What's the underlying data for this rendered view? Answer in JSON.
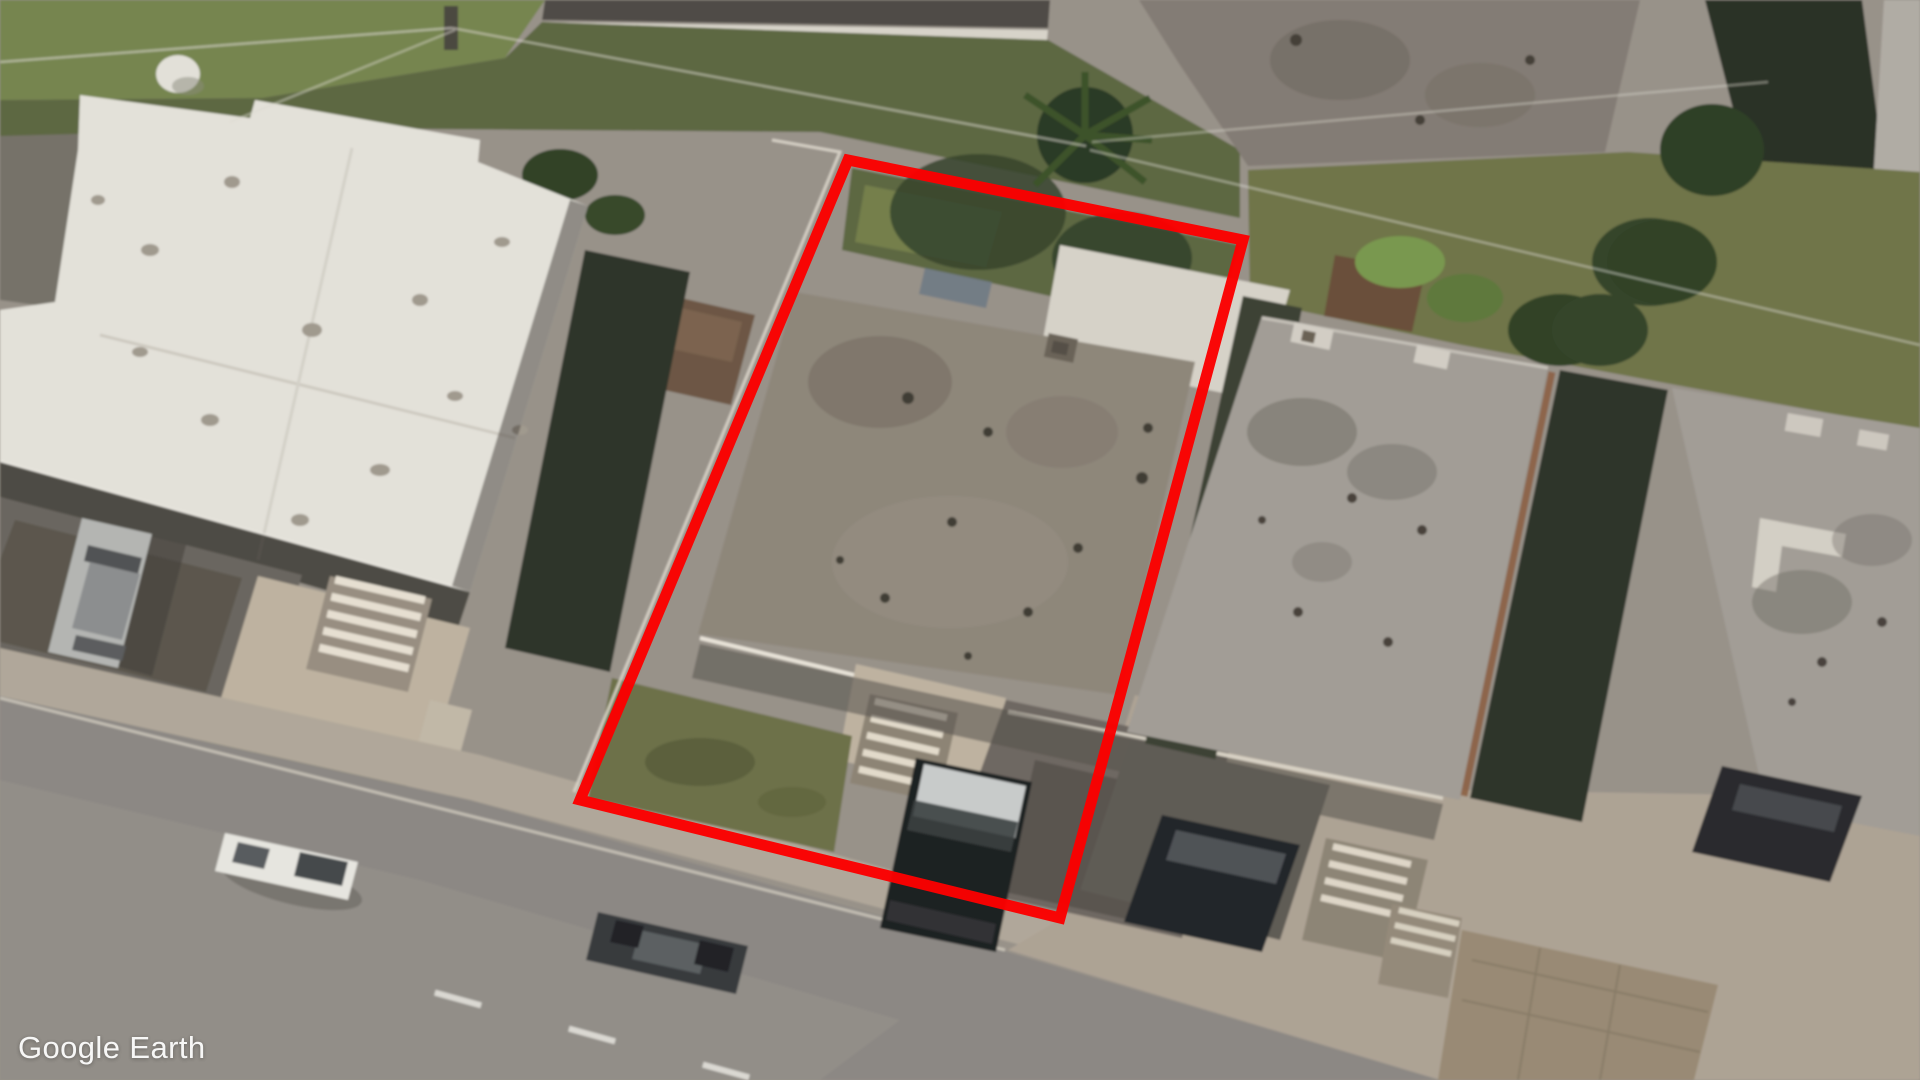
{
  "app": {
    "watermark": "Google Earth"
  },
  "annotation": {
    "type": "property-parcel-outline",
    "color": "#fb0000",
    "stroke_width": 11,
    "points": "848,160 1243,240 1060,918 580,800"
  },
  "palette": {
    "asphalt": "#8e8a86",
    "sidewalk": "#b4aa9d",
    "concrete": "#c2b6a4",
    "white_roof": "#e9e7e0",
    "target_roof": "#90887c",
    "neighbor_roof": "#a5a099",
    "top_roof": "#847d75",
    "grass": "#5c6841",
    "grass_bright": "#77864e",
    "lawn": "#6d7148",
    "weeds": "#6f7547",
    "tree": "#2e4025",
    "hedge": "#2c3326",
    "shadow": "#3b4034",
    "car_white": "#edebe6",
    "car_silver": "#b8b9b7",
    "car_dark": "#34373b",
    "car_black": "#1a1c1e"
  },
  "scene": {
    "type": "oblique-aerial-satellite-imagery",
    "subject": "residential block with one parcel highlighted by red outline"
  }
}
